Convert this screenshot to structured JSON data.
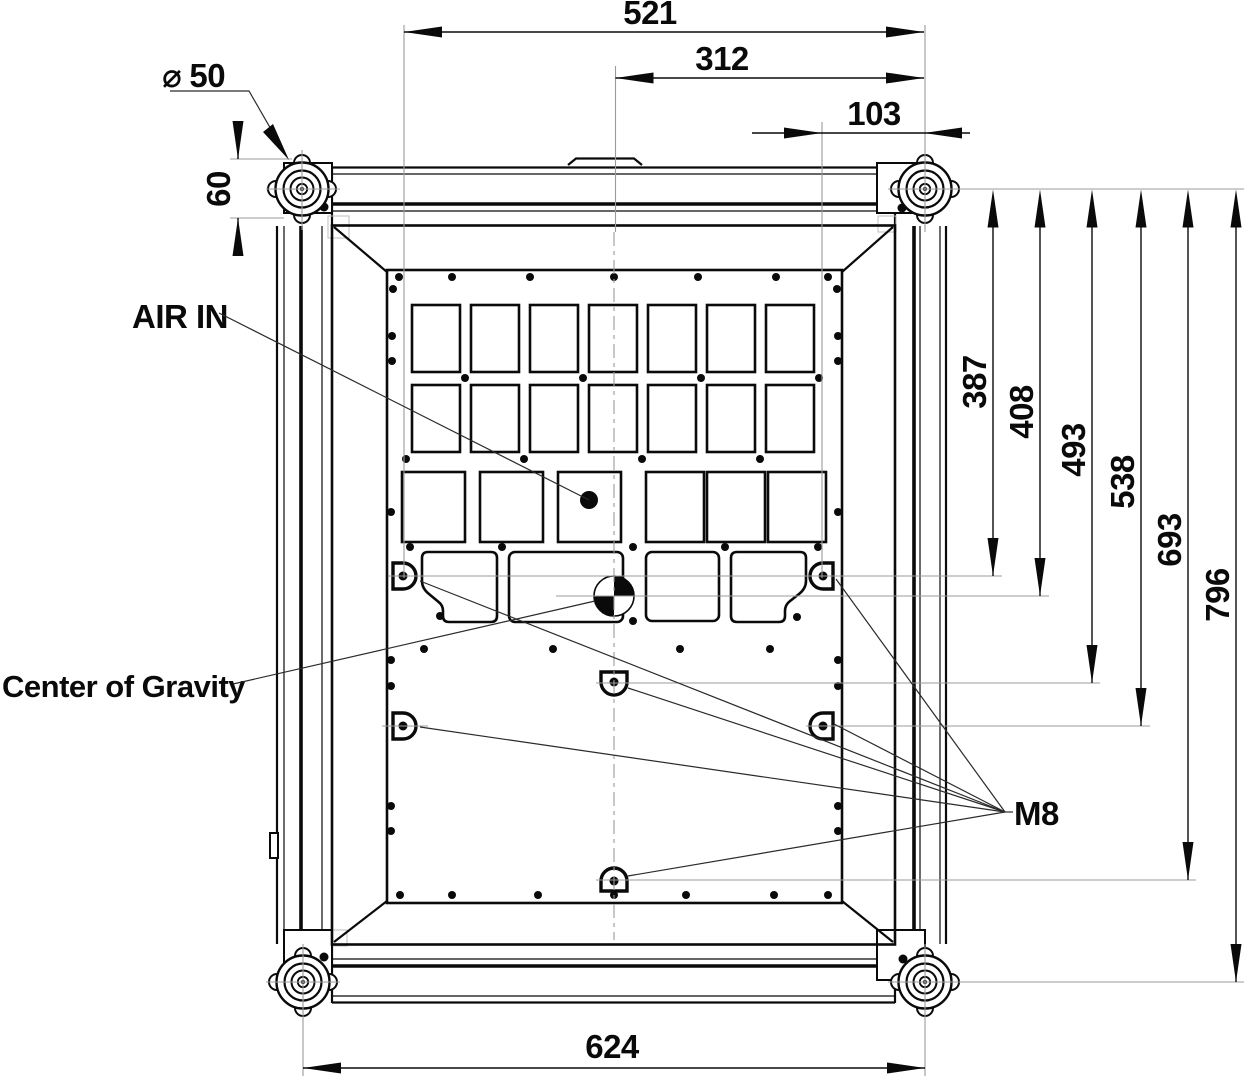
{
  "labels": {
    "air_in": "AIR IN",
    "center_of_gravity": "Center of Gravity",
    "thread_size": "M8"
  },
  "dimensions": {
    "top": {
      "overall": "521",
      "mid": "312",
      "small": "103"
    },
    "right": {
      "r1": "387",
      "r2": "408",
      "r3": "493",
      "r4": "538",
      "r5": "693",
      "r6": "796"
    },
    "bottom": {
      "overall": "624"
    },
    "left": {
      "rail_height": "60"
    },
    "caster": {
      "diameter_symbol": "⌀",
      "diameter": "50"
    }
  },
  "colors": {
    "line": "#0a0a0a",
    "construction": "#9b9b9b",
    "background": "#ffffff"
  }
}
